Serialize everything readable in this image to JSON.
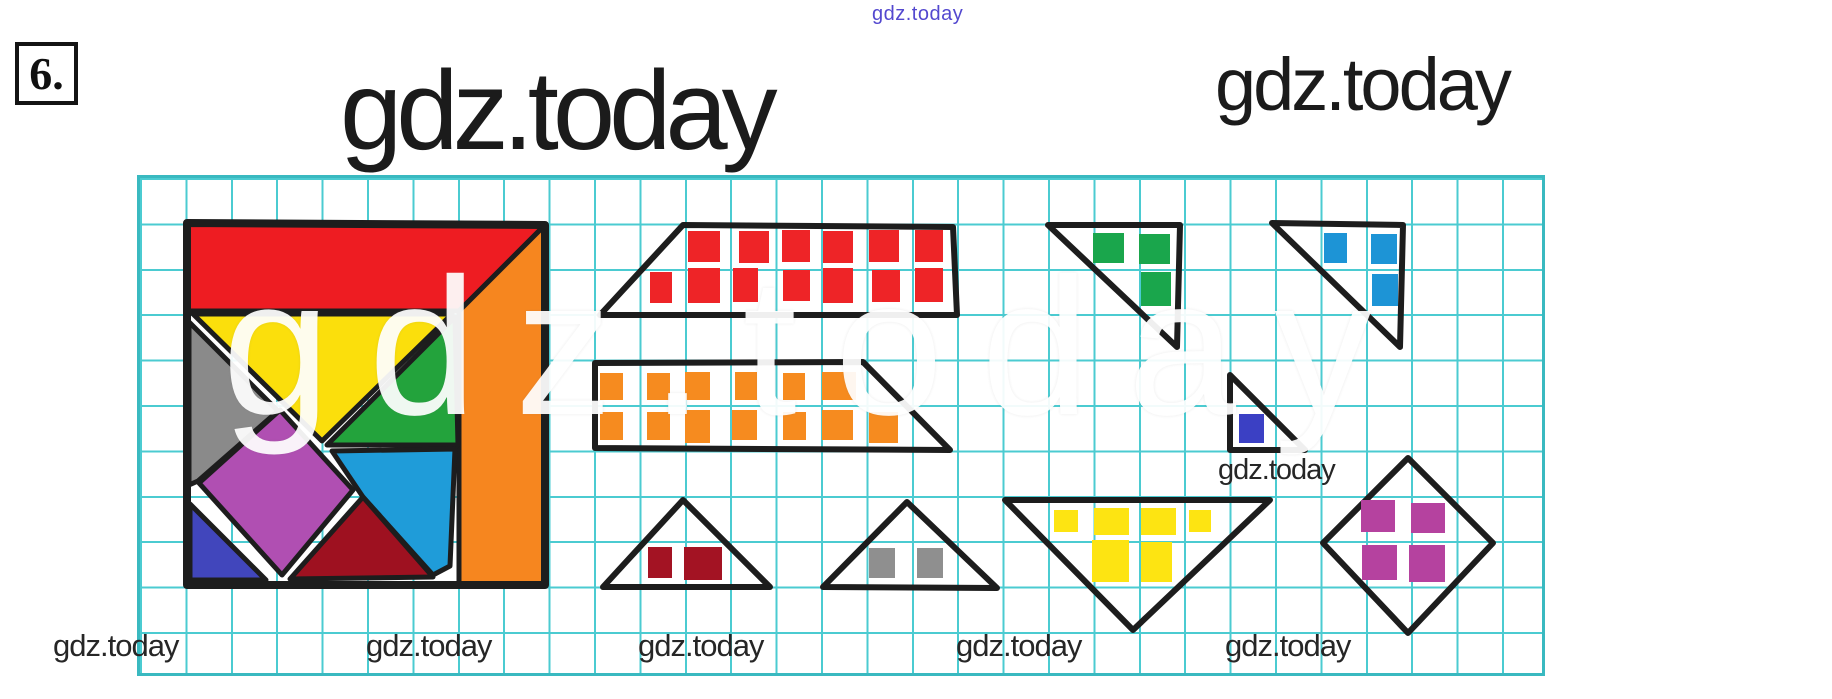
{
  "page": {
    "problem_number": "6.",
    "watermark_top": "gdz.today",
    "title_main": "gdz.today",
    "title_right": "gdz.today",
    "watermark_mid": "gdz.today",
    "watermarks_bottom": [
      "gdz.today",
      "gdz.today",
      "gdz.today",
      "gdz.today",
      "gdz.today"
    ],
    "big_watermark": "gdz.today"
  },
  "colors": {
    "grid_line": "#2cc3c9",
    "grid_border": "#17adb6",
    "outline": "#1d1d1d",
    "text": "#262626",
    "purple": "#5348cf",
    "red": "#ee1c22",
    "orange": "#f6861f",
    "yellow": "#fbdf0c",
    "green": "#23a33c",
    "gray": "#8a8a8a",
    "magenta": "#b04fb2",
    "blue": "#1f9cd9",
    "dark_red": "#9e1120",
    "indigo": "#4146bc",
    "sq_red": "#ee2427",
    "sq_orange": "#f68b1f",
    "sq_green": "#1aa64c",
    "sq_blue": "#1d94d6",
    "sq_indigo": "#3b40c4",
    "sq_yellow": "#fde412",
    "sq_magenta": "#b5429f",
    "sq_dark_red": "#a31323",
    "sq_gray": "#8f8f8f"
  },
  "figure": {
    "grid": {
      "x": 137,
      "y": 175,
      "width": 1408,
      "height": 501,
      "cell": 45.4
    },
    "tangram": {
      "x": 187,
      "y": 223,
      "border_points": "0,0 358,2 358,362 0,362",
      "pieces": [
        {
          "name": "piece-red-trapezoid",
          "color": "red",
          "points": "0,0 358,2 272,88 0,88"
        },
        {
          "name": "piece-orange-strip",
          "color": "orange",
          "points": "358,2 358,362 272,362 272,88"
        },
        {
          "name": "piece-yellow-triangle",
          "color": "yellow",
          "points": "6,91 265,91 135,218"
        },
        {
          "name": "piece-green-triangle",
          "color": "green",
          "points": "268,94 271,222 140,222"
        },
        {
          "name": "piece-gray-triangle",
          "color": "gray",
          "points": "2,99 91,188 11,258 2,262"
        },
        {
          "name": "piece-magenta-square",
          "color": "magenta",
          "points": "93,187 166,267 95,352 12,260"
        },
        {
          "name": "piece-blue-triangle",
          "color": "blue",
          "points": "145,228 268,226 263,343 246,352 176,274"
        },
        {
          "name": "piece-darkred-triangle",
          "color": "dark_red",
          "points": "176,274 103,356 246,354"
        },
        {
          "name": "piece-indigo-triangle",
          "color": "indigo",
          "points": "3,281 3,357 79,357"
        }
      ]
    },
    "shapes": [
      {
        "name": "trapezoid-red-units",
        "outline": "600,315 683,225 953,227 957,315",
        "square_color": "sq_red",
        "count": 13,
        "squares": [
          [
            688,
            231,
            32,
            31
          ],
          [
            739,
            231,
            30,
            32
          ],
          [
            782,
            230,
            28,
            32
          ],
          [
            823,
            231,
            30,
            32
          ],
          [
            869,
            230,
            30,
            32
          ],
          [
            915,
            230,
            28,
            32
          ],
          [
            650,
            272,
            22,
            31
          ],
          [
            688,
            268,
            32,
            35
          ],
          [
            733,
            268,
            25,
            34
          ],
          [
            783,
            270,
            27,
            31
          ],
          [
            823,
            268,
            30,
            35
          ],
          [
            872,
            270,
            28,
            32
          ],
          [
            915,
            268,
            28,
            34
          ]
        ]
      },
      {
        "name": "trapezoid-orange-units",
        "outline": "595,363 863,362 950,450 595,448",
        "square_color": "sq_orange",
        "count": 13,
        "squares": [
          [
            600,
            373,
            23,
            27
          ],
          [
            647,
            373,
            23,
            27
          ],
          [
            685,
            372,
            25,
            28
          ],
          [
            735,
            372,
            22,
            28
          ],
          [
            783,
            373,
            22,
            27
          ],
          [
            822,
            372,
            34,
            28
          ],
          [
            600,
            412,
            23,
            28
          ],
          [
            647,
            412,
            23,
            28
          ],
          [
            685,
            410,
            25,
            33
          ],
          [
            732,
            410,
            25,
            30
          ],
          [
            783,
            412,
            23,
            28
          ],
          [
            822,
            410,
            31,
            30
          ],
          [
            869,
            412,
            29,
            31
          ]
        ]
      },
      {
        "name": "triangle-darkred-units",
        "outline": "683,500 603,587 770,587",
        "square_color": "sq_dark_red",
        "count": 2,
        "squares": [
          [
            648,
            547,
            24,
            31
          ],
          [
            684,
            547,
            38,
            33
          ]
        ]
      },
      {
        "name": "triangle-gray-units",
        "outline": "907,502 823,587 997,588",
        "square_color": "sq_gray",
        "count": 2,
        "squares": [
          [
            869,
            548,
            26,
            30
          ],
          [
            917,
            548,
            26,
            30
          ]
        ]
      },
      {
        "name": "triangle-green-units",
        "outline": "1048,225 1180,225 1177,347",
        "square_color": "sq_green",
        "count": 3,
        "squares": [
          [
            1093,
            233,
            31,
            30
          ],
          [
            1139,
            234,
            31,
            30
          ],
          [
            1141,
            272,
            30,
            34
          ]
        ]
      },
      {
        "name": "triangle-blue-units",
        "outline": "1272,223 1403,225 1400,347",
        "square_color": "sq_blue",
        "count": 3,
        "squares": [
          [
            1324,
            233,
            23,
            30
          ],
          [
            1371,
            234,
            26,
            30
          ],
          [
            1372,
            274,
            26,
            32
          ]
        ]
      },
      {
        "name": "triangle-small-indigo-unit",
        "outline": "1230,375 1230,450 1305,450",
        "square_color": "sq_indigo",
        "count": 1,
        "squares": [
          [
            1239,
            414,
            25,
            29
          ]
        ]
      },
      {
        "name": "triangle-yellow-units",
        "outline": "1005,500 1270,500 1133,630",
        "square_color": "sq_yellow",
        "count": 6,
        "squares": [
          [
            1054,
            510,
            24,
            22
          ],
          [
            1094,
            508,
            35,
            27
          ],
          [
            1141,
            508,
            35,
            27
          ],
          [
            1189,
            510,
            22,
            22
          ],
          [
            1092,
            540,
            37,
            42
          ],
          [
            1141,
            542,
            31,
            40
          ]
        ]
      },
      {
        "name": "diamond-magenta-units",
        "outline": "1408,458 1493,543 1408,633 1323,543",
        "square_color": "sq_magenta",
        "count": 4,
        "squares": [
          [
            1361,
            500,
            34,
            32
          ],
          [
            1411,
            503,
            34,
            30
          ],
          [
            1362,
            545,
            35,
            35
          ],
          [
            1409,
            545,
            36,
            37
          ]
        ]
      }
    ]
  }
}
